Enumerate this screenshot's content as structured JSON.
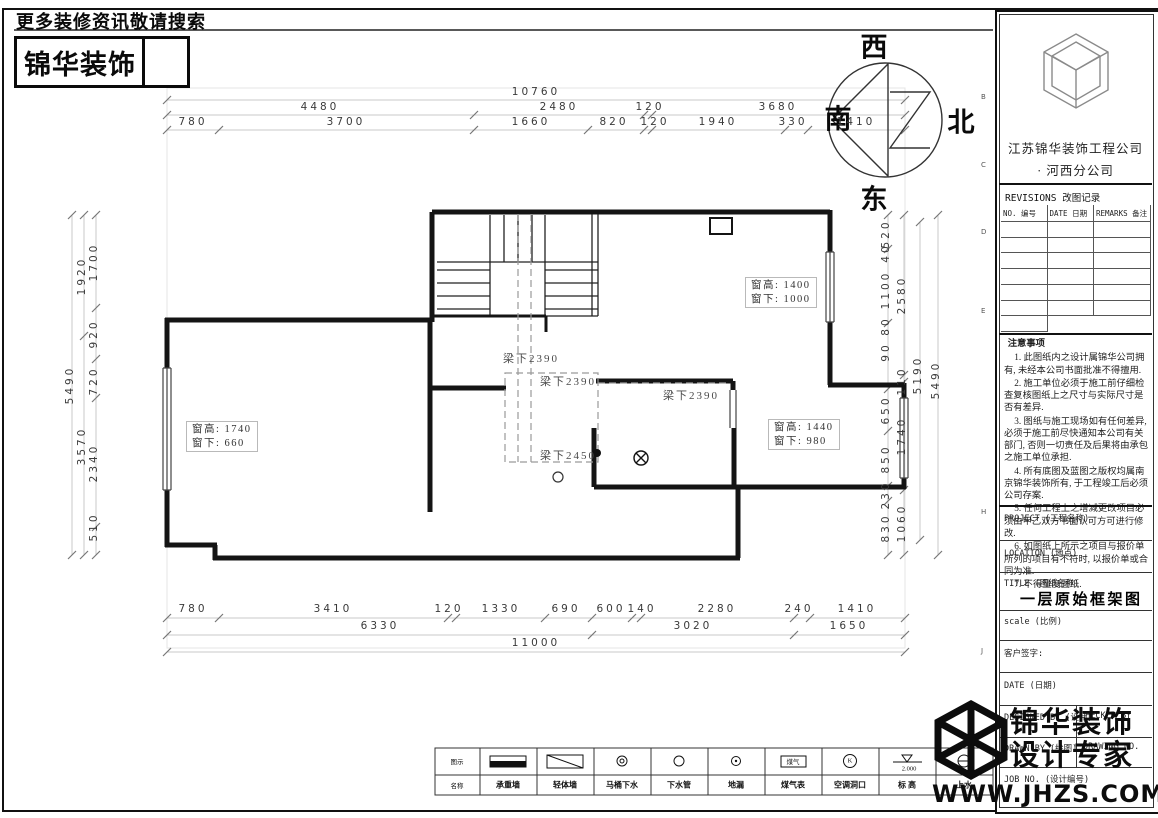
{
  "header": {
    "tagline": "更多装修资讯敬请搜索",
    "logo_text": "锦华装饰"
  },
  "compass": {
    "west": "西",
    "north": "北",
    "east": "东",
    "south": "南"
  },
  "dims": {
    "top": {
      "row1": [
        "10760"
      ],
      "row2": [
        "4480",
        "2480",
        "120",
        "3680"
      ],
      "row3": [
        "780",
        "3700",
        "1660",
        "820",
        "120",
        "1940",
        "330",
        "1410"
      ]
    },
    "bottom": {
      "row1": [
        "780",
        "3410",
        "120",
        "1330",
        "690",
        "600",
        "140",
        "2280",
        "240",
        "1410"
      ],
      "row2": [
        "6330",
        "3020",
        "1650"
      ],
      "row3": [
        "11000"
      ]
    },
    "left": {
      "inner": [
        "1700",
        "920",
        "720",
        "2340",
        "510"
      ],
      "mid": [
        "1920",
        "3570"
      ],
      "outer": [
        "5490"
      ]
    },
    "right": {
      "inner": [
        "520",
        "40",
        "1100",
        "80",
        "90",
        "650",
        "850",
        "230",
        "830"
      ],
      "mid": [
        "2580",
        "110",
        "1740",
        "1060"
      ],
      "outer": [
        "5190",
        "5490"
      ]
    }
  },
  "plan": {
    "beam_labels": [
      "梁下2390",
      "梁下2390",
      "梁下2390",
      "梁下2450"
    ],
    "window_labels": [
      {
        "l1": "窗高: 1400",
        "l2": "窗下: 1000"
      },
      {
        "l1": "窗高: 1740",
        "l2": "窗下: 660"
      },
      {
        "l1": "窗高: 1440",
        "l2": "窗下: 980"
      }
    ]
  },
  "title_block": {
    "company": "江苏锦华装饰工程公司",
    "branch": "·    河西分公司",
    "revisions_title": "REVISIONS 改图记录",
    "rev_cols": [
      "NO. 编号",
      "DATE 日期",
      "REMARKS 备注"
    ],
    "notes_title": "注意事项",
    "notes": [
      "1. 此图纸内之设计属锦华公司拥有, 未经本公司书面批准不得擅用.",
      "2. 施工单位必须于施工前仔细检查复核图纸上之尺寸与实际尺寸是否有差异.",
      "3. 图纸与施工现场如有任何差异, 必须于施工前尽快通知本公司有关部门, 否则一切责任及后果将由承包之施工单位承担.",
      "4. 所有底图及蓝图之版权均属南京锦华装饰所有, 于工程竣工后必须公司存案.",
      "5. 任何工程上之增减更改项目必须由甲乙双方书面认可方可进行修改.",
      "6. 如图纸上所示之项目与报价单所列的项目有不符时, 以报价单或合同为准.",
      "7. 不得量度图纸."
    ],
    "fields": {
      "project": "PROJECT (工程名称)",
      "location": "LOCATION (地点)",
      "title": "TITLE (图纸名称)",
      "drawing_title": "一层原始框架图",
      "scale": "scale  (比例)",
      "client_sign": "客户签字:",
      "date": "DATE (日期)",
      "designed_by": "DESIGNED BY (设计)",
      "checked_by": "CHECKED BY",
      "drawn_by": "DRAWN BY (绘图)",
      "drawing_no": "DRAWING NO.",
      "job_no": "JOB NO. (设计编号)"
    },
    "frame_refs": [
      "B",
      "C",
      "D",
      "E",
      "H",
      "J"
    ]
  },
  "watermark": {
    "line1": "锦华装饰",
    "line2": "设计专家",
    "url": "WWW.JHZS.COM"
  },
  "legend": {
    "row_symbol": "图示",
    "row_name": "名称",
    "gas_text": "煤气",
    "k_text": "K",
    "elev_text": "2.000",
    "items": [
      {
        "label": "承重墙"
      },
      {
        "label": "轻体墙"
      },
      {
        "label": "马桶下水"
      },
      {
        "label": "下水管"
      },
      {
        "label": "地漏"
      },
      {
        "label": "煤气表"
      },
      {
        "label": "空调洞口"
      },
      {
        "label": "标 高"
      },
      {
        "label": "上水"
      }
    ]
  }
}
